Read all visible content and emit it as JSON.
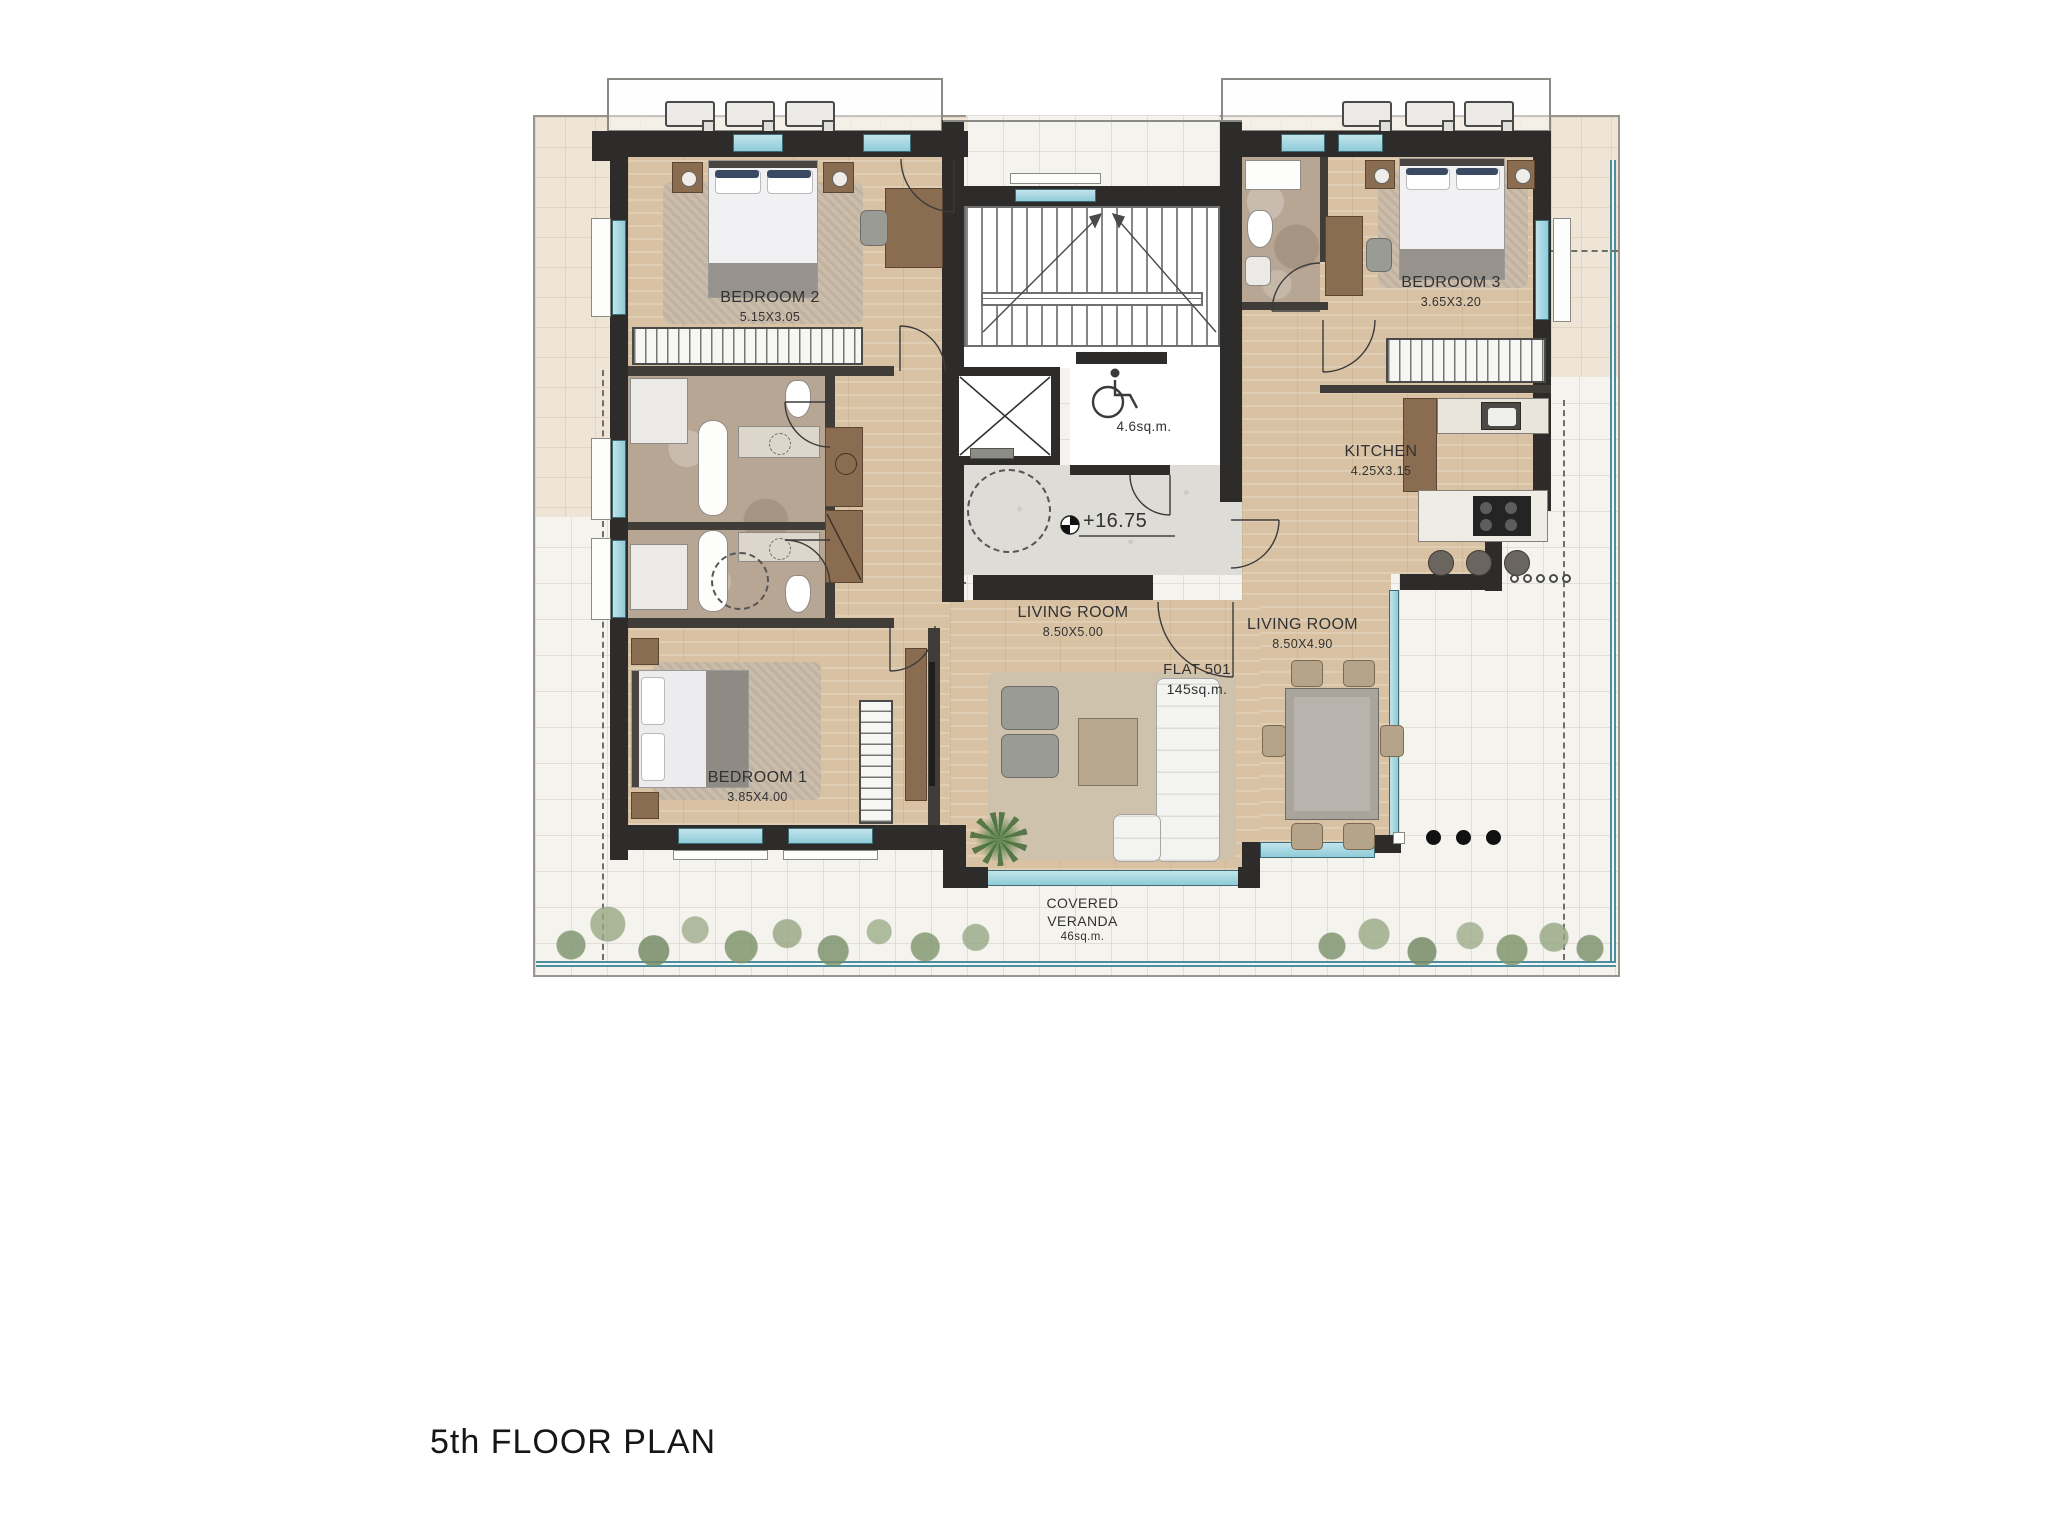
{
  "page": {
    "title": "5th FLOOR PLAN"
  },
  "flat": {
    "name": "FLAT 501",
    "area": "145sq.m."
  },
  "rooms": {
    "bedroom2": {
      "name": "BEDROOM 2",
      "dims": "5.15X3.05"
    },
    "bedroom3": {
      "name": "BEDROOM 3",
      "dims": "3.65X3.20"
    },
    "bedroom1": {
      "name": "BEDROOM 1",
      "dims": "3.85X4.00"
    },
    "kitchen": {
      "name": "KITCHEN",
      "dims": "4.25X3.15"
    },
    "living_center": {
      "name": "LIVING ROOM",
      "dims": "8.50X5.00"
    },
    "living_right": {
      "name": "LIVING ROOM",
      "dims": "8.50X4.90"
    },
    "stair_lobby": {
      "area": "4.6sq.m."
    },
    "veranda": {
      "line1": "COVERED",
      "line2": "VERANDA",
      "area": "46sq.m."
    }
  },
  "level_marker": {
    "value": "+16.75"
  },
  "colors": {
    "wall": "#2e2c2a",
    "wood_floor": "#d8c2a3",
    "stone_floor": "#b7a694",
    "terrace": "#f5f3ee",
    "glazing_teal": "#8ecbd8",
    "terrace_edge_teal": "#4e8d9c",
    "label_text": "#323232"
  }
}
